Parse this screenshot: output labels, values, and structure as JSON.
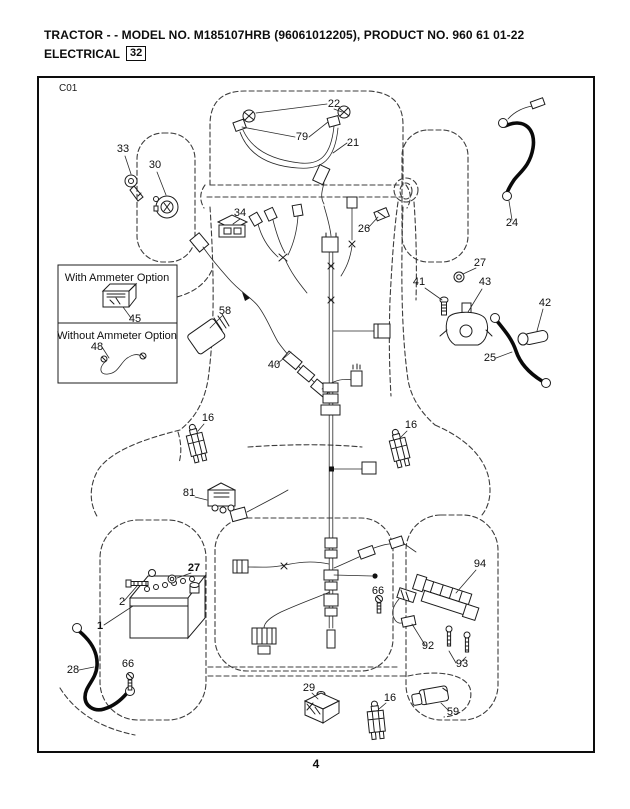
{
  "header": {
    "title_line1": "TRACTOR - - MODEL NO. M185107HRB  (96061012205), PRODUCT NO. 960 61 01-22",
    "title_line2": "ELECTRICAL",
    "section_number": "32"
  },
  "diagram": {
    "sheet_code": "C01",
    "page_number": "4",
    "labels": [
      {
        "id": "22",
        "text": "22",
        "x": 334,
        "y": 107
      },
      {
        "id": "79",
        "text": "79",
        "x": 302,
        "y": 140
      },
      {
        "id": "21",
        "text": "21",
        "x": 353,
        "y": 146
      },
      {
        "id": "33",
        "text": "33",
        "x": 123,
        "y": 152
      },
      {
        "id": "30",
        "text": "30",
        "x": 155,
        "y": 168
      },
      {
        "id": "34",
        "text": "34",
        "x": 240,
        "y": 216
      },
      {
        "id": "26",
        "text": "26",
        "x": 364,
        "y": 232
      },
      {
        "id": "24",
        "text": "24",
        "x": 512,
        "y": 226
      },
      {
        "id": "27-solenoid",
        "text": "27",
        "x": 480,
        "y": 266
      },
      {
        "id": "41",
        "text": "41",
        "x": 419,
        "y": 285
      },
      {
        "id": "43",
        "text": "43",
        "x": 485,
        "y": 285
      },
      {
        "id": "42",
        "text": "42",
        "x": 545,
        "y": 306
      },
      {
        "id": "25",
        "text": "25",
        "x": 490,
        "y": 361
      },
      {
        "id": "58",
        "text": "58",
        "x": 225,
        "y": 314
      },
      {
        "id": "45",
        "text": "45",
        "x": 135,
        "y": 322
      },
      {
        "id": "48",
        "text": "48",
        "x": 97,
        "y": 350
      },
      {
        "id": "40",
        "text": "40",
        "x": 274,
        "y": 368
      },
      {
        "id": "16-left",
        "text": "16",
        "x": 208,
        "y": 421
      },
      {
        "id": "16-right",
        "text": "16",
        "x": 411,
        "y": 428
      },
      {
        "id": "81",
        "text": "81",
        "x": 189,
        "y": 496
      },
      {
        "id": "27-battery",
        "text": "27",
        "x": 194,
        "y": 571,
        "bold": true
      },
      {
        "id": "2",
        "text": "2",
        "x": 122,
        "y": 605
      },
      {
        "id": "1",
        "text": "1",
        "x": 100,
        "y": 629,
        "bold": true
      },
      {
        "id": "94",
        "text": "94",
        "x": 480,
        "y": 567
      },
      {
        "id": "66-right",
        "text": "66",
        "x": 378,
        "y": 594,
        "size": 9
      },
      {
        "id": "92",
        "text": "92",
        "x": 428,
        "y": 649
      },
      {
        "id": "93",
        "text": "93",
        "x": 462,
        "y": 667
      },
      {
        "id": "28",
        "text": "28",
        "x": 73,
        "y": 673
      },
      {
        "id": "66-left",
        "text": "66",
        "x": 128,
        "y": 667,
        "size": 9
      },
      {
        "id": "29",
        "text": "29",
        "x": 309,
        "y": 691
      },
      {
        "id": "16-bottom",
        "text": "16",
        "x": 390,
        "y": 701
      },
      {
        "id": "59",
        "text": "59",
        "x": 453,
        "y": 715
      },
      {
        "id": "opt-with",
        "text": "With Ammeter Option",
        "x": 117,
        "y": 281,
        "size": 9.5
      },
      {
        "id": "opt-without",
        "text": "Without Ammeter Option",
        "x": 117,
        "y": 339,
        "size": 9.5
      }
    ]
  }
}
